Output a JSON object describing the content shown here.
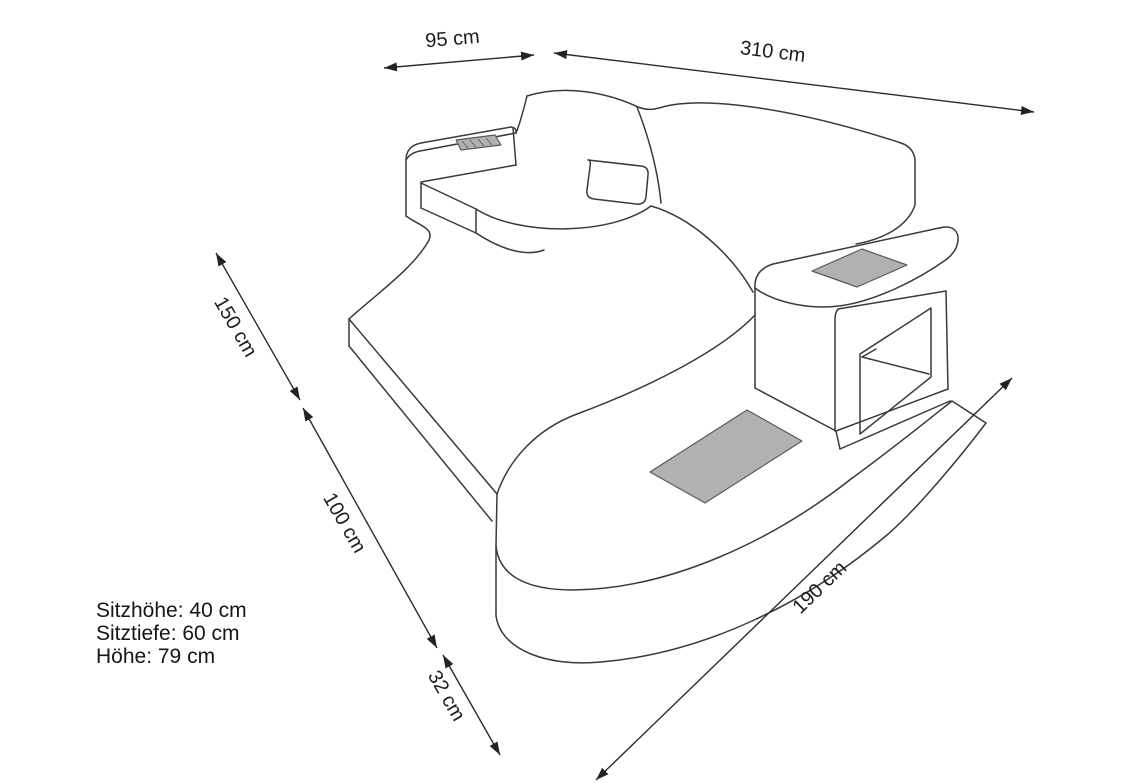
{
  "dimensions": {
    "d95": "95 cm",
    "d310": "310 cm",
    "d150": "150 cm",
    "d100": "100 cm",
    "d32": "32 cm",
    "d190": "190 cm"
  },
  "specs": {
    "seat_height": "Sitzhöhe: 40 cm",
    "seat_depth": "Sitztiefe: 60 cm",
    "height": "Höhe: 79 cm"
  },
  "colors": {
    "background": "#ffffff",
    "line": "#3a3a3a",
    "dimension_line": "#2b2b2b",
    "text": "#1c1c1c",
    "insert_fill": "#b1b1b1",
    "insert_stroke": "#5a5a5a"
  }
}
